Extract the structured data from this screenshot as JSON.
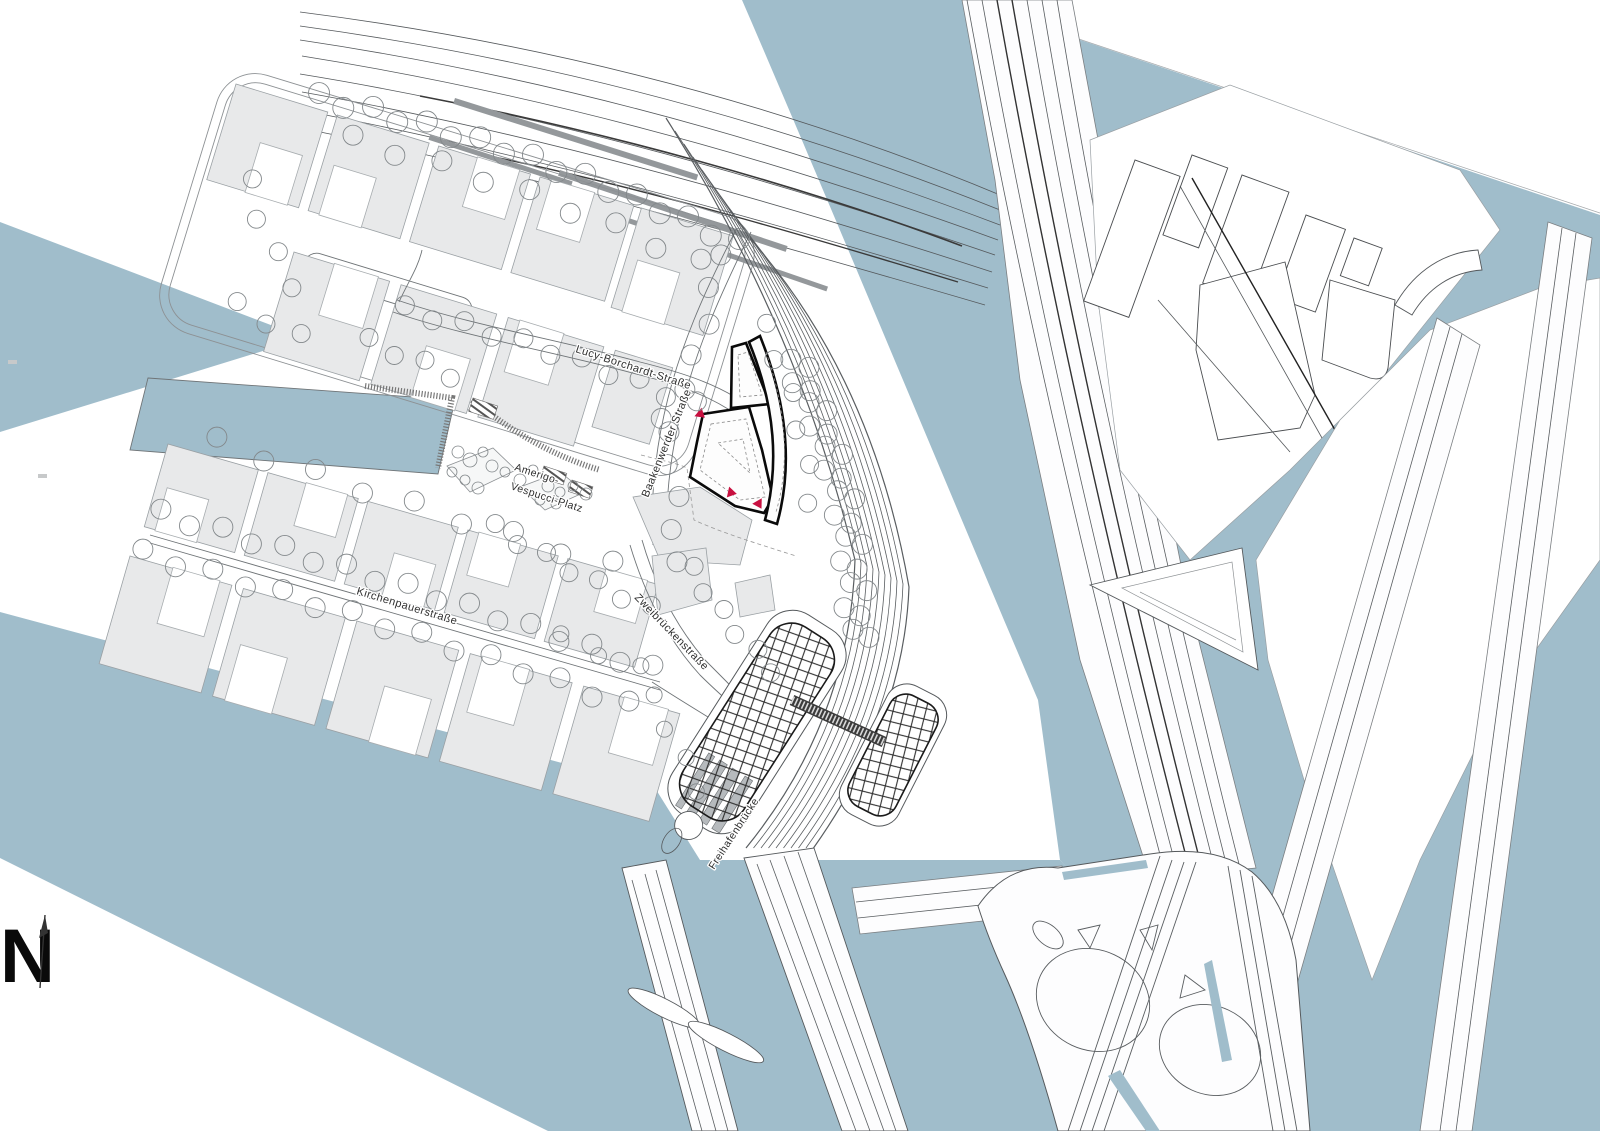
{
  "map": {
    "north_indicator": {
      "label": "N"
    },
    "street_labels": {
      "lucy_borchardt": "Lucy-Borchardt-Straße",
      "baakenwerder": "Baakenwerder Straße",
      "amerigo_vespucci_line1": "Amerigo-",
      "amerigo_vespucci_line2": "Vespucci-Platz",
      "kirchenpauer": "Kirchenpauerstraße",
      "zweibruecken": "Zweibrückenstraße",
      "freihafenbruecke": "Freihafenbrücke"
    },
    "colors": {
      "water": "#a0bdcb",
      "building_fill": "#e8e9ea",
      "building_stroke": "#9aa0a4",
      "line": "#55595c",
      "highlight_outline": "#0a0a0a",
      "entrance_marker": "#c81040"
    },
    "markers": {
      "entrance_marker_count": 3
    }
  }
}
